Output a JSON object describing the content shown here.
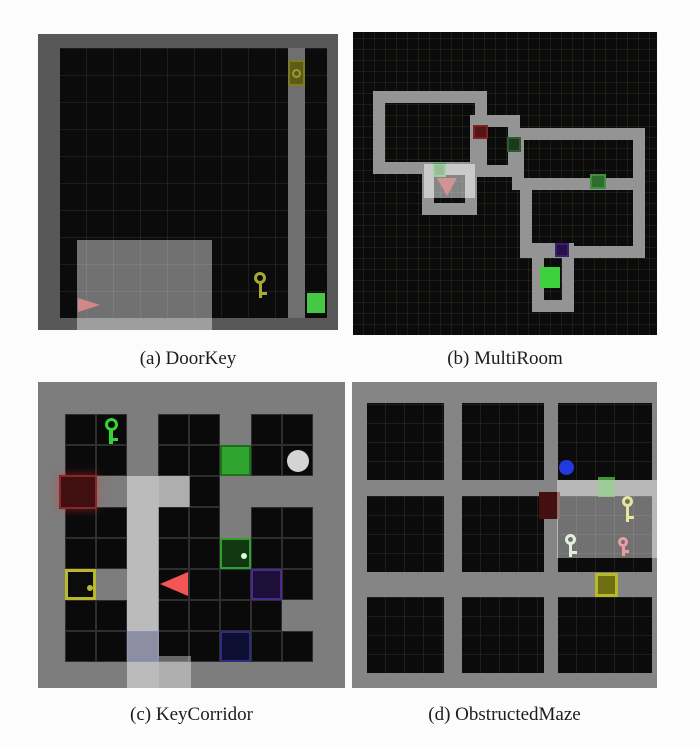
{
  "figure": {
    "captions": {
      "a": "(a) DoorKey",
      "b": "(b) MultiRoom",
      "c": "(c) KeyCorridor",
      "d": "(d) ObstructedMaze"
    }
  },
  "panels": {
    "a": {
      "frame": {
        "x": 38,
        "y": 34,
        "w": 300,
        "h": 296,
        "bg": "#0b0b0b"
      },
      "elements": [
        {
          "name": "floor-grid",
          "t": "rect",
          "x": 22,
          "y": 14,
          "w": 267,
          "h": 270,
          "bg": "#0b0b0b",
          "grid": {
            "gs": 27,
            "gl": "rgba(255,255,255,0.08)"
          }
        },
        {
          "name": "wall-column",
          "t": "rect",
          "x": 250,
          "y": 14,
          "w": 17,
          "h": 270,
          "bg": "#6f6f6f"
        },
        {
          "name": "locked-door-yellow",
          "t": "door",
          "x": 250,
          "y": 26,
          "w": 17,
          "h": 26,
          "bg": "#5c5c16",
          "bc": "#7c7c26",
          "bw": 2,
          "knob": "ring",
          "kc": "#9a9a35"
        },
        {
          "name": "goal-square-green",
          "t": "rect",
          "x": 269,
          "y": 259,
          "w": 18,
          "h": 20,
          "bg": "#46c846"
        },
        {
          "name": "key-yellow-icon",
          "t": "key",
          "x": 214,
          "y": 238,
          "w": 16,
          "h": 26,
          "fg": "#a8a832"
        },
        {
          "name": "agent-triangle-red",
          "t": "tri",
          "x": 40,
          "y": 264,
          "w": 22,
          "h": 14,
          "dir": "right",
          "bg": "#b23232"
        },
        {
          "name": "border-wall-frame",
          "t": "frame",
          "x": 0,
          "y": 0,
          "w": 300,
          "h": 296,
          "bc": "#585858",
          "bws": "14px 11px 12px 22px"
        },
        {
          "name": "agent-view-highlight",
          "t": "rect",
          "x": 39,
          "y": 206,
          "w": 135,
          "h": 90,
          "bg": "rgba(255,255,255,0.42)"
        }
      ]
    },
    "b": {
      "frame": {
        "x": 353,
        "y": 32,
        "w": 304,
        "h": 303,
        "bg": "#0b0b0b",
        "grid": {
          "gs": 11,
          "gl": "rgba(70,100,55,0.22)"
        }
      },
      "elements": [
        {
          "name": "room-top-left",
          "t": "frame",
          "x": 20,
          "y": 59,
          "w": 114,
          "h": 83,
          "bc": "#949494",
          "bws": "12px"
        },
        {
          "name": "room-middle-small",
          "t": "frame",
          "x": 117,
          "y": 83,
          "w": 50,
          "h": 62,
          "bc": "#949494",
          "bws": "12px"
        },
        {
          "name": "room-right-upper",
          "t": "frame",
          "x": 159,
          "y": 96,
          "w": 133,
          "h": 62,
          "bc": "#949494",
          "bws": "12px"
        },
        {
          "name": "room-right-lower",
          "t": "frame",
          "x": 167,
          "y": 146,
          "w": 125,
          "h": 80,
          "bc": "#949494",
          "bws": "12px"
        },
        {
          "name": "room-goal",
          "t": "frame",
          "x": 179,
          "y": 211,
          "w": 42,
          "h": 69,
          "bc": "#949494",
          "bws": "12px"
        },
        {
          "name": "room-agent",
          "t": "frame",
          "x": 69,
          "y": 131,
          "w": 55,
          "h": 52,
          "bc": "#949494",
          "bws": "12px"
        },
        {
          "name": "door-red",
          "t": "door",
          "x": 120,
          "y": 93,
          "w": 15,
          "h": 14,
          "bg": "#521414",
          "bc": "#7e2222",
          "bw": 2
        },
        {
          "name": "door-dark-green",
          "t": "door",
          "x": 154,
          "y": 105,
          "w": 14,
          "h": 15,
          "bg": "#1b3a1b",
          "bc": "#2c5c2c",
          "bw": 2
        },
        {
          "name": "door-green-middle",
          "t": "door",
          "x": 237,
          "y": 142,
          "w": 16,
          "h": 15,
          "bg": "#2d6e2d",
          "bc": "#3f8f3f",
          "bw": 2
        },
        {
          "name": "door-purple",
          "t": "door",
          "x": 202,
          "y": 211,
          "w": 14,
          "h": 14,
          "bg": "#261045",
          "bc": "#3c1e6e",
          "bw": 2
        },
        {
          "name": "door-green-agent-room",
          "t": "door",
          "x": 80,
          "y": 131,
          "w": 13,
          "h": 14,
          "bg": "#2f7a2f",
          "bc": "#44a044",
          "bw": 2
        },
        {
          "name": "goal-square-green",
          "t": "rect",
          "x": 187,
          "y": 235,
          "w": 20,
          "h": 21,
          "bg": "#3ecf3e"
        },
        {
          "name": "agent-triangle-red",
          "t": "tri",
          "x": 84,
          "y": 146,
          "w": 20,
          "h": 18,
          "dir": "down",
          "bg": "#a02828"
        },
        {
          "name": "agent-view-highlight",
          "t": "rect",
          "x": 71,
          "y": 132,
          "w": 51,
          "h": 34,
          "bg": "rgba(255,255,255,0.5)"
        }
      ]
    },
    "c": {
      "frame": {
        "x": 38,
        "y": 382,
        "w": 307,
        "h": 306,
        "bg": "#7d7d7d"
      },
      "cells": {
        "x": 27,
        "y": 32,
        "cw": 31,
        "ch": 31,
        "bg": "#0a0a0a",
        "line": "#2e2e2e",
        "rows": [
          "KK.KK.KK",
          "KK.KK.KK",
          "....K...",
          "KK.KK.KK",
          "KK.KK.KK",
          "...KKK.K",
          "KK.KKKK.",
          "KK.KK.KK"
        ]
      },
      "elements": [
        {
          "name": "key-green-icon",
          "t": "key",
          "x": 64,
          "y": 36,
          "w": 18,
          "h": 26,
          "fg": "#35d435"
        },
        {
          "name": "door-green-open",
          "t": "door",
          "x": 182,
          "y": 63,
          "w": 31,
          "h": 31,
          "bg": "#2fa52f",
          "bc": "#1e701e",
          "bw": 2
        },
        {
          "name": "ball-white",
          "t": "circle",
          "x": 249,
          "y": 68,
          "w": 22,
          "h": 22,
          "bg": "#d4d4d4"
        },
        {
          "name": "door-red-locked",
          "t": "door",
          "x": 21,
          "y": 93,
          "w": 38,
          "h": 34,
          "bg": "#401010",
          "bc": "#8a2626",
          "bw": 2,
          "shadow": "0 0 10px rgba(220,60,60,0.5)"
        },
        {
          "name": "door-green-locked",
          "t": "door",
          "x": 182,
          "y": 156,
          "w": 31,
          "h": 31,
          "bg": "#113811",
          "bc": "#2f9f2f",
          "bw": 2,
          "knob": "dot",
          "kc": "#d6ffd6"
        },
        {
          "name": "box-yellow",
          "t": "door",
          "x": 27,
          "y": 187,
          "w": 31,
          "h": 31,
          "bg": "#0c0c0c",
          "bc": "#b9b92a",
          "bw": 3,
          "knob": "dot",
          "kc": "#b9b92a"
        },
        {
          "name": "door-purple",
          "t": "door",
          "x": 213,
          "y": 187,
          "w": 31,
          "h": 31,
          "bg": "#1c0f38",
          "bc": "#4a2a8e",
          "bw": 2
        },
        {
          "name": "agent-triangle-red",
          "t": "tri",
          "x": 122,
          "y": 190,
          "w": 28,
          "h": 25,
          "dir": "left",
          "bg": "#f25555"
        },
        {
          "name": "door-blue-left",
          "t": "door",
          "x": 89,
          "y": 249,
          "w": 31,
          "h": 31,
          "bg": "rgba(25,25,70,0.85)",
          "bc": "#30308a",
          "bw": 1
        },
        {
          "name": "door-blue-right",
          "t": "door",
          "x": 182,
          "y": 249,
          "w": 31,
          "h": 31,
          "bg": "#0e0e32",
          "bc": "#2d2d7e",
          "bw": 2
        },
        {
          "name": "corridor-view-highlight",
          "t": "rect",
          "x": 89,
          "y": 94,
          "w": 32,
          "h": 212,
          "bg": "rgba(255,255,255,0.48)"
        },
        {
          "name": "corridor-view-highlight-top",
          "t": "rect",
          "x": 121,
          "y": 94,
          "w": 31,
          "h": 31,
          "bg": "rgba(255,255,255,0.38)"
        },
        {
          "name": "corridor-view-highlight-bottom",
          "t": "rect",
          "x": 121,
          "y": 274,
          "w": 32,
          "h": 32,
          "bg": "rgba(255,255,255,0.38)"
        }
      ]
    },
    "d": {
      "frame": {
        "x": 352,
        "y": 382,
        "w": 305,
        "h": 306,
        "bg": "#858585"
      },
      "elements": [
        {
          "name": "room-1-1",
          "t": "rect",
          "x": 15,
          "y": 21,
          "w": 77,
          "h": 77,
          "bg": "#0b0b0b",
          "grid": {
            "gs": 19,
            "gl": "rgba(255,255,255,0.08)"
          }
        },
        {
          "name": "room-1-2",
          "t": "rect",
          "x": 110,
          "y": 21,
          "w": 82,
          "h": 77,
          "bg": "#0b0b0b",
          "grid": {
            "gs": 19,
            "gl": "rgba(255,255,255,0.08)"
          }
        },
        {
          "name": "room-1-3",
          "t": "rect",
          "x": 206,
          "y": 21,
          "w": 94,
          "h": 77,
          "bg": "#0b0b0b",
          "grid": {
            "gs": 19,
            "gl": "rgba(255,255,255,0.08)"
          }
        },
        {
          "name": "room-2-1",
          "t": "rect",
          "x": 15,
          "y": 114,
          "w": 77,
          "h": 76,
          "bg": "#0b0b0b",
          "grid": {
            "gs": 19,
            "gl": "rgba(255,255,255,0.08)"
          }
        },
        {
          "name": "room-2-2",
          "t": "rect",
          "x": 110,
          "y": 114,
          "w": 82,
          "h": 76,
          "bg": "#0b0b0b",
          "grid": {
            "gs": 19,
            "gl": "rgba(255,255,255,0.08)"
          }
        },
        {
          "name": "room-2-3",
          "t": "rect",
          "x": 206,
          "y": 114,
          "w": 94,
          "h": 76,
          "bg": "#0b0b0b",
          "grid": {
            "gs": 19,
            "gl": "rgba(255,255,255,0.08)"
          }
        },
        {
          "name": "room-3-1",
          "t": "rect",
          "x": 15,
          "y": 215,
          "w": 77,
          "h": 76,
          "bg": "#0b0b0b",
          "grid": {
            "gs": 19,
            "gl": "rgba(255,255,255,0.08)"
          }
        },
        {
          "name": "room-3-2",
          "t": "rect",
          "x": 110,
          "y": 215,
          "w": 82,
          "h": 76,
          "bg": "#0b0b0b",
          "grid": {
            "gs": 19,
            "gl": "rgba(255,255,255,0.08)"
          }
        },
        {
          "name": "room-3-3",
          "t": "rect",
          "x": 206,
          "y": 215,
          "w": 94,
          "h": 76,
          "bg": "#0b0b0b",
          "grid": {
            "gs": 19,
            "gl": "rgba(255,255,255,0.08)"
          }
        },
        {
          "name": "ball-blue",
          "t": "circle",
          "x": 207,
          "y": 78,
          "w": 15,
          "h": 15,
          "bg": "#2238e0"
        },
        {
          "name": "door-green",
          "t": "rect",
          "x": 246,
          "y": 95,
          "w": 17,
          "h": 20,
          "bg": "rgba(80,170,70,0.85)"
        },
        {
          "name": "door-red",
          "t": "rect",
          "x": 187,
          "y": 110,
          "w": 21,
          "h": 27,
          "bg": "#44100f"
        },
        {
          "name": "key-yellow-icon",
          "t": "key",
          "x": 268,
          "y": 114,
          "w": 15,
          "h": 26,
          "fg": "#d6d650"
        },
        {
          "name": "key-pale-icon",
          "t": "key",
          "x": 211,
          "y": 152,
          "w": 15,
          "h": 23,
          "fg": "#cfe6c8"
        },
        {
          "name": "key-red-icon",
          "t": "key",
          "x": 264,
          "y": 155,
          "w": 14,
          "h": 19,
          "fg": "#e05565"
        },
        {
          "name": "box-yellow",
          "t": "door",
          "x": 243,
          "y": 191,
          "w": 23,
          "h": 24,
          "bg": "#6e6e12",
          "bc": "#b9b927",
          "bw": 3
        },
        {
          "name": "agent-view-highlight",
          "t": "rect",
          "x": 205,
          "y": 98,
          "w": 100,
          "h": 78,
          "bg": "rgba(255,255,255,0.42)"
        }
      ]
    }
  }
}
